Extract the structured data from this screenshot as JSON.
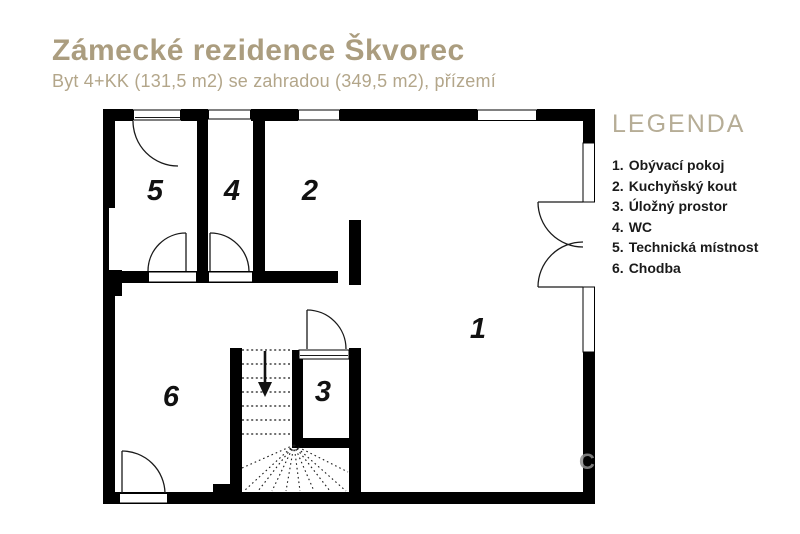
{
  "header": {
    "title": "Zámecké rezidence Škvorec",
    "subtitle": "Byt 4+KK (131,5 m2) se zahradou (349,5 m2), přízemí"
  },
  "legend": {
    "heading": "LEGENDA",
    "items": [
      {
        "num": "1.",
        "label": "Obývací pokoj"
      },
      {
        "num": "2.",
        "label": "Kuchyňský kout"
      },
      {
        "num": "3.",
        "label": "Úložný prostor"
      },
      {
        "num": "4.",
        "label": "WC"
      },
      {
        "num": "5.",
        "label": "Technická místnost"
      },
      {
        "num": "6.",
        "label": "Chodba"
      }
    ]
  },
  "plan": {
    "room_labels": {
      "living": "1",
      "kitchen": "2",
      "storage": "3",
      "wc": "4",
      "technical": "5",
      "hallway": "6"
    },
    "stairs_direction": "down",
    "watermark": "C"
  },
  "colors": {
    "accent_title": "#ab9d7f",
    "accent_subtitle": "#b3a68a",
    "accent_legend_heading": "#b6ad96",
    "legend_text": "#1a1a1a",
    "walls": "#000000",
    "background": "#ffffff"
  }
}
